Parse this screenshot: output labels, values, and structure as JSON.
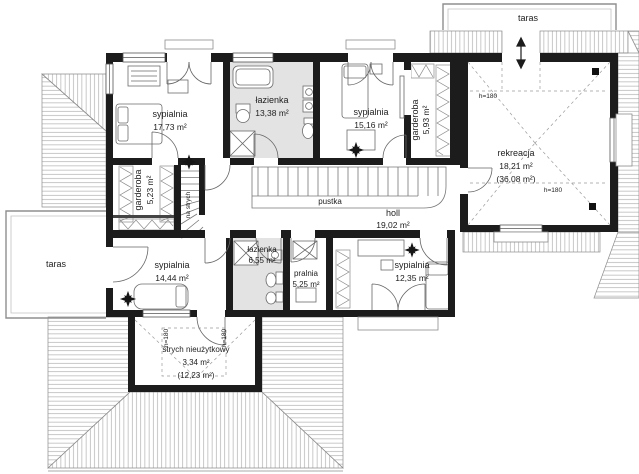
{
  "floorplan": {
    "rooms": {
      "sypialnia_nw": {
        "name": "sypialnia",
        "area": "17,73 m²"
      },
      "lazienka_top": {
        "name": "łazienka",
        "area": "13,38 m²"
      },
      "sypialnia_n": {
        "name": "sypialnia",
        "area": "15,16 m²"
      },
      "garderoba_e": {
        "name": "garderoba",
        "area": "5,93 m²"
      },
      "rekreacja": {
        "name": "rekreacja",
        "area": "18,21 m²",
        "area_total": "(36,08 m²)"
      },
      "garderoba_w": {
        "name": "garderoba",
        "area": "5,23 m²"
      },
      "pustka": "pustka",
      "holl": {
        "name": "holl",
        "area": "19,02 m²"
      },
      "sypialnia_sw": {
        "name": "sypialnia",
        "area": "14,44 m²"
      },
      "lazienka_dol": {
        "name": "łazienka",
        "area": "6,55 m²"
      },
      "pralnia": {
        "name": "pralnia",
        "area": "5,25 m²"
      },
      "sypialnia_se": {
        "name": "sypialnia",
        "area": "12,35 m²"
      },
      "strych": {
        "name": "strych nieużytkowy",
        "area": "3,34 m²",
        "area_total": "(12,23 m²)"
      },
      "taras_left": "taras",
      "taras_top": "taras"
    },
    "annotations": {
      "na_strych": "na strych",
      "h180": "h=180"
    },
    "colors": {
      "wall": "#1c1c1c",
      "bath_fill": "#e3e3e3",
      "hatch": "#a3a3a3",
      "thin_line": "#666666"
    }
  }
}
